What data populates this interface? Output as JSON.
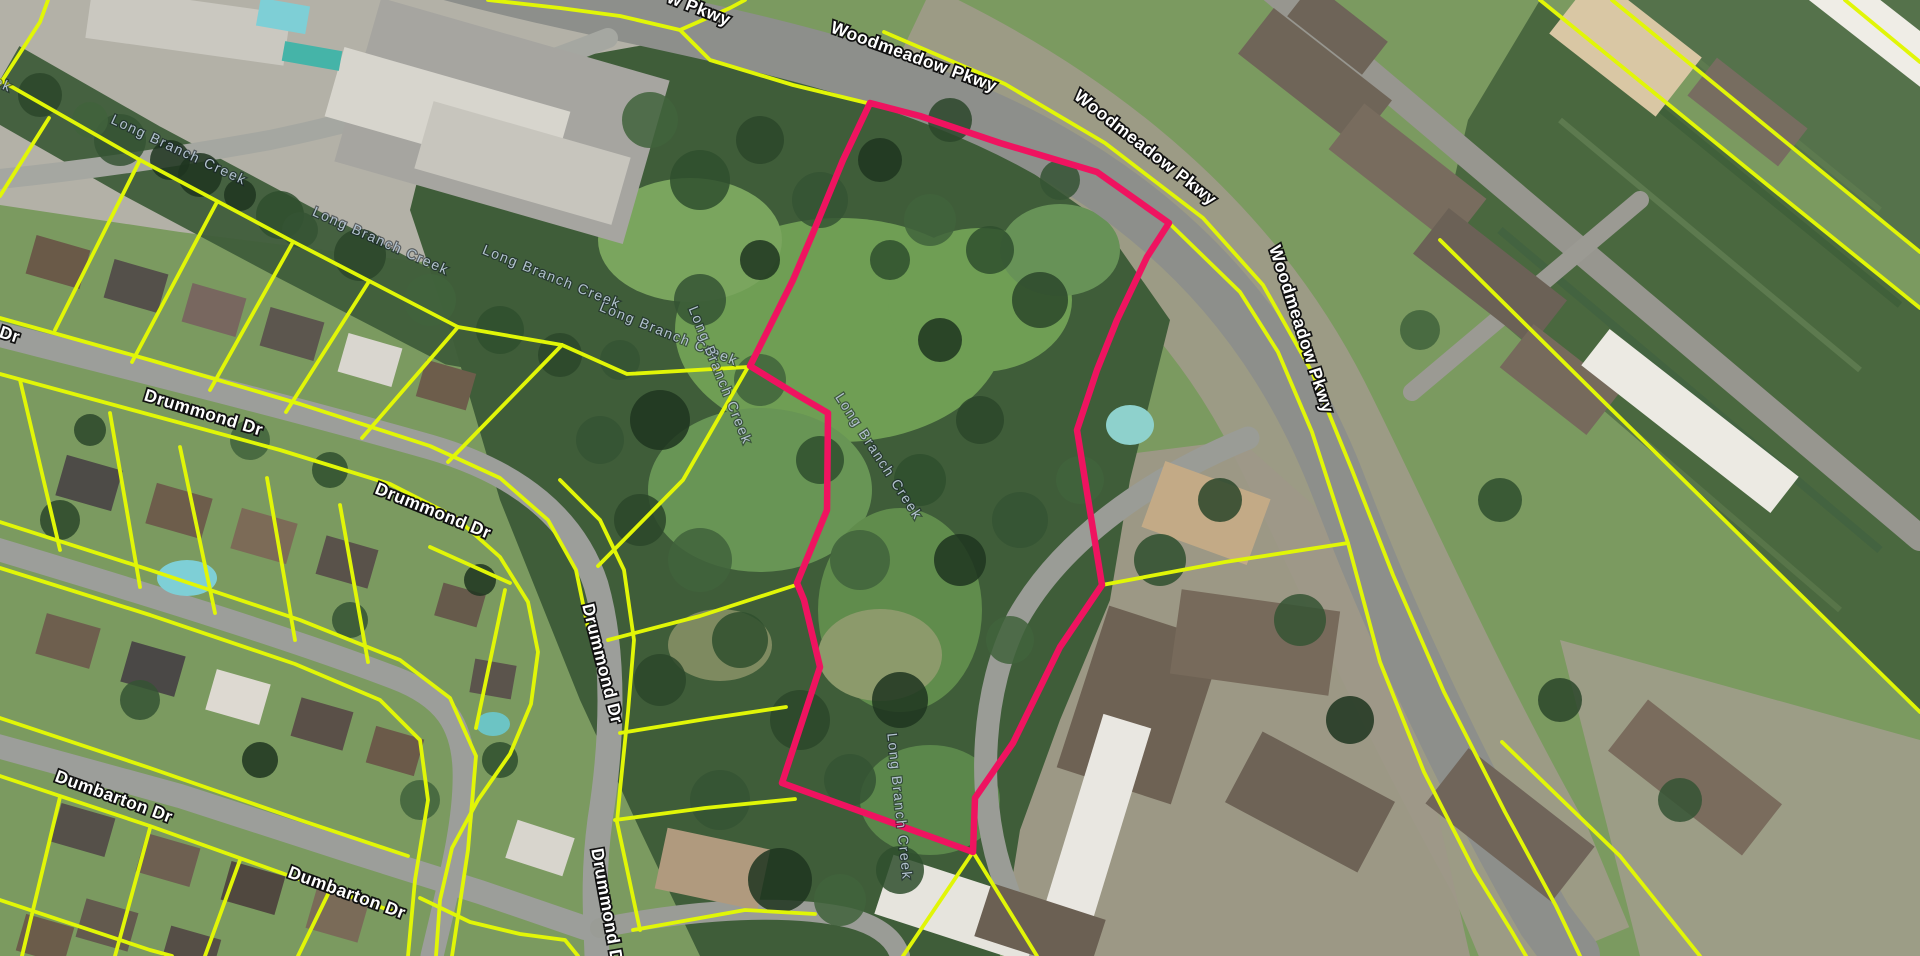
{
  "map": {
    "description": "Aerial parcel map with highlighted property along Woodmeadow Pkwy and Long Branch Creek",
    "colors": {
      "parcel_line": "#e1f607",
      "highlight": "#ef1360",
      "street_label_fill": "#ffffff",
      "street_label_halo": "#111111",
      "creek_label_fill": "#b2c2ce"
    },
    "highlight_parcel": {
      "name": "highlighted-parcel",
      "points": [
        [
          870,
          103
        ],
        [
          920,
          116
        ],
        [
          1000,
          143
        ],
        [
          1097,
          172
        ],
        [
          1169,
          223
        ],
        [
          1147,
          257
        ],
        [
          1117,
          320
        ],
        [
          1097,
          370
        ],
        [
          1077,
          430
        ],
        [
          1085,
          480
        ],
        [
          1102,
          585
        ],
        [
          1060,
          647
        ],
        [
          1013,
          743
        ],
        [
          975,
          798
        ],
        [
          973,
          852
        ],
        [
          782,
          783
        ],
        [
          820,
          667
        ],
        [
          804,
          600
        ],
        [
          797,
          583
        ],
        [
          827,
          510
        ],
        [
          828,
          413
        ],
        [
          799,
          396
        ],
        [
          750,
          366
        ],
        [
          793,
          280
        ],
        [
          813,
          233
        ],
        [
          843,
          160
        ]
      ]
    },
    "parcel_lines": [
      [
        [
          0,
          80
        ],
        [
          140,
          160
        ],
        [
          290,
          240
        ],
        [
          458,
          327
        ],
        [
          562,
          345
        ],
        [
          627,
          374
        ],
        [
          748,
          367
        ]
      ],
      [
        [
          0,
          84
        ],
        [
          40,
          22
        ],
        [
          48,
          0
        ]
      ],
      [
        [
          49,
          118
        ],
        [
          0,
          196
        ]
      ],
      [
        [
          140,
          160
        ],
        [
          55,
          330
        ]
      ],
      [
        [
          217,
          202
        ],
        [
          132,
          362
        ]
      ],
      [
        [
          293,
          242
        ],
        [
          210,
          390
        ]
      ],
      [
        [
          368,
          283
        ],
        [
          286,
          412
        ]
      ],
      [
        [
          458,
          327
        ],
        [
          362,
          438
        ]
      ],
      [
        [
          562,
          345
        ],
        [
          448,
          462
        ]
      ],
      [
        [
          748,
          367
        ],
        [
          683,
          480
        ],
        [
          598,
          566
        ]
      ],
      [
        [
          608,
          640
        ],
        [
          700,
          616
        ],
        [
          796,
          585
        ]
      ],
      [
        [
          620,
          733
        ],
        [
          706,
          719
        ],
        [
          786,
          707
        ]
      ],
      [
        [
          615,
          820
        ],
        [
          705,
          808
        ],
        [
          795,
          799
        ]
      ],
      [
        [
          633,
          930
        ],
        [
          745,
          910
        ],
        [
          815,
          914
        ]
      ],
      [
        [
          0,
          318
        ],
        [
          150,
          360
        ],
        [
          300,
          404
        ],
        [
          430,
          446
        ],
        [
          500,
          478
        ],
        [
          548,
          520
        ],
        [
          576,
          570
        ],
        [
          588,
          628
        ]
      ],
      [
        [
          0,
          374
        ],
        [
          140,
          412
        ],
        [
          280,
          450
        ],
        [
          390,
          484
        ],
        [
          455,
          517
        ],
        [
          500,
          557
        ],
        [
          528,
          602
        ],
        [
          538,
          652
        ],
        [
          531,
          704
        ],
        [
          510,
          754
        ],
        [
          478,
          800
        ],
        [
          452,
          848
        ],
        [
          440,
          900
        ],
        [
          436,
          956
        ]
      ],
      [
        [
          560,
          480
        ],
        [
          600,
          520
        ],
        [
          624,
          570
        ],
        [
          634,
          640
        ],
        [
          628,
          712
        ],
        [
          620,
          790
        ],
        [
          617,
          822
        ],
        [
          640,
          930
        ]
      ],
      [
        [
          0,
          522
        ],
        [
          150,
          570
        ],
        [
          300,
          620
        ],
        [
          400,
          660
        ],
        [
          450,
          698
        ],
        [
          476,
          756
        ],
        [
          468,
          850
        ],
        [
          452,
          956
        ]
      ],
      [
        [
          0,
          568
        ],
        [
          150,
          615
        ],
        [
          295,
          664
        ],
        [
          380,
          700
        ],
        [
          420,
          740
        ],
        [
          428,
          800
        ],
        [
          415,
          880
        ],
        [
          408,
          956
        ]
      ],
      [
        [
          20,
          380
        ],
        [
          60,
          550
        ]
      ],
      [
        [
          110,
          413
        ],
        [
          140,
          587
        ]
      ],
      [
        [
          180,
          447
        ],
        [
          215,
          613
        ]
      ],
      [
        [
          267,
          478
        ],
        [
          295,
          640
        ]
      ],
      [
        [
          340,
          505
        ],
        [
          368,
          662
        ]
      ],
      [
        [
          430,
          547
        ],
        [
          510,
          583
        ]
      ],
      [
        [
          505,
          590
        ],
        [
          476,
          728
        ]
      ],
      [
        [
          0,
          718
        ],
        [
          150,
          768
        ],
        [
          300,
          820
        ],
        [
          408,
          856
        ]
      ],
      [
        [
          0,
          776
        ],
        [
          150,
          826
        ],
        [
          290,
          876
        ],
        [
          395,
          912
        ]
      ],
      [
        [
          420,
          898
        ],
        [
          470,
          922
        ],
        [
          520,
          934
        ],
        [
          565,
          940
        ],
        [
          578,
          956
        ]
      ],
      [
        [
          60,
          797
        ],
        [
          22,
          956
        ]
      ],
      [
        [
          150,
          828
        ],
        [
          115,
          956
        ]
      ],
      [
        [
          240,
          860
        ],
        [
          205,
          956
        ]
      ],
      [
        [
          330,
          890
        ],
        [
          298,
          956
        ]
      ],
      [
        [
          0,
          900
        ],
        [
          150,
          950
        ],
        [
          172,
          956
        ]
      ],
      [
        [
          884,
          32
        ],
        [
          1005,
          84
        ],
        [
          1105,
          143
        ],
        [
          1203,
          218
        ],
        [
          1263,
          285
        ],
        [
          1312,
          372
        ],
        [
          1352,
          470
        ],
        [
          1393,
          575
        ],
        [
          1444,
          692
        ],
        [
          1505,
          812
        ],
        [
          1556,
          906
        ],
        [
          1580,
          956
        ]
      ],
      [
        [
          1169,
          223
        ],
        [
          1240,
          292
        ],
        [
          1278,
          352
        ],
        [
          1312,
          432
        ],
        [
          1348,
          543
        ],
        [
          1380,
          662
        ],
        [
          1424,
          772
        ],
        [
          1475,
          872
        ],
        [
          1512,
          932
        ],
        [
          1526,
          956
        ]
      ],
      [
        [
          1102,
          585
        ],
        [
          1225,
          562
        ],
        [
          1348,
          543
        ]
      ],
      [
        [
          488,
          0
        ],
        [
          560,
          8
        ],
        [
          620,
          16
        ],
        [
          680,
          30
        ],
        [
          710,
          60
        ],
        [
          793,
          85
        ],
        [
          867,
          103
        ]
      ],
      [
        [
          680,
          30
        ],
        [
          730,
          8
        ],
        [
          745,
          0
        ]
      ],
      [
        [
          973,
          852
        ],
        [
          903,
          956
        ]
      ],
      [
        [
          973,
          852
        ],
        [
          1037,
          956
        ]
      ],
      [
        [
          1540,
          0
        ],
        [
          1770,
          187
        ],
        [
          1920,
          308
        ]
      ],
      [
        [
          1612,
          0
        ],
        [
          1920,
          252
        ]
      ],
      [
        [
          1440,
          240
        ],
        [
          1602,
          400
        ],
        [
          1920,
          712
        ]
      ],
      [
        [
          1845,
          0
        ],
        [
          1920,
          62
        ]
      ],
      [
        [
          1502,
          742
        ],
        [
          1620,
          856
        ],
        [
          1700,
          956
        ]
      ]
    ],
    "street_labels": [
      {
        "text": "w Pkwy",
        "x": 697,
        "y": 14,
        "rotate": 21
      },
      {
        "text": "Woodmeadow Pkwy",
        "x": 912,
        "y": 62,
        "rotate": 20
      },
      {
        "text": "Woodmeadow Pkwy",
        "x": 1142,
        "y": 152,
        "rotate": 38
      },
      {
        "text": "Woodmeadow Pkwy",
        "x": 1296,
        "y": 331,
        "rotate": 72
      },
      {
        "text": "Drummond Dr",
        "x": 202,
        "y": 418,
        "rotate": 17
      },
      {
        "text": "Drummond Dr",
        "x": 431,
        "y": 516,
        "rotate": 22
      },
      {
        "text": "Drummond Dr",
        "x": 597,
        "y": 665,
        "rotate": 76
      },
      {
        "text": "Drummond Dr",
        "x": 602,
        "y": 910,
        "rotate": 80
      },
      {
        "text": "Dumbarton Dr",
        "x": 112,
        "y": 802,
        "rotate": 20
      },
      {
        "text": "Dumbarton Dr",
        "x": 345,
        "y": 898,
        "rotate": 20
      },
      {
        "text": "Dr",
        "x": 8,
        "y": 340,
        "rotate": 18
      }
    ],
    "creek_labels": [
      {
        "text": "Long Branch Creek",
        "x": -58,
        "y": 62,
        "rotate": 24
      },
      {
        "text": "Long Branch Creek",
        "x": 177,
        "y": 154,
        "rotate": 25
      },
      {
        "text": "Long Branch Creek",
        "x": 379,
        "y": 245,
        "rotate": 24
      },
      {
        "text": "Long Branch Creek",
        "x": 550,
        "y": 281,
        "rotate": 22
      },
      {
        "text": "Long Branch Creek",
        "x": 667,
        "y": 338,
        "rotate": 22
      },
      {
        "text": "Long Branch Creek",
        "x": 716,
        "y": 377,
        "rotate": 68
      },
      {
        "text": "Long Branch Creek",
        "x": 875,
        "y": 459,
        "rotate": 57
      },
      {
        "text": "Long Branch Creek",
        "x": 895,
        "y": 807,
        "rotate": 84
      }
    ]
  }
}
